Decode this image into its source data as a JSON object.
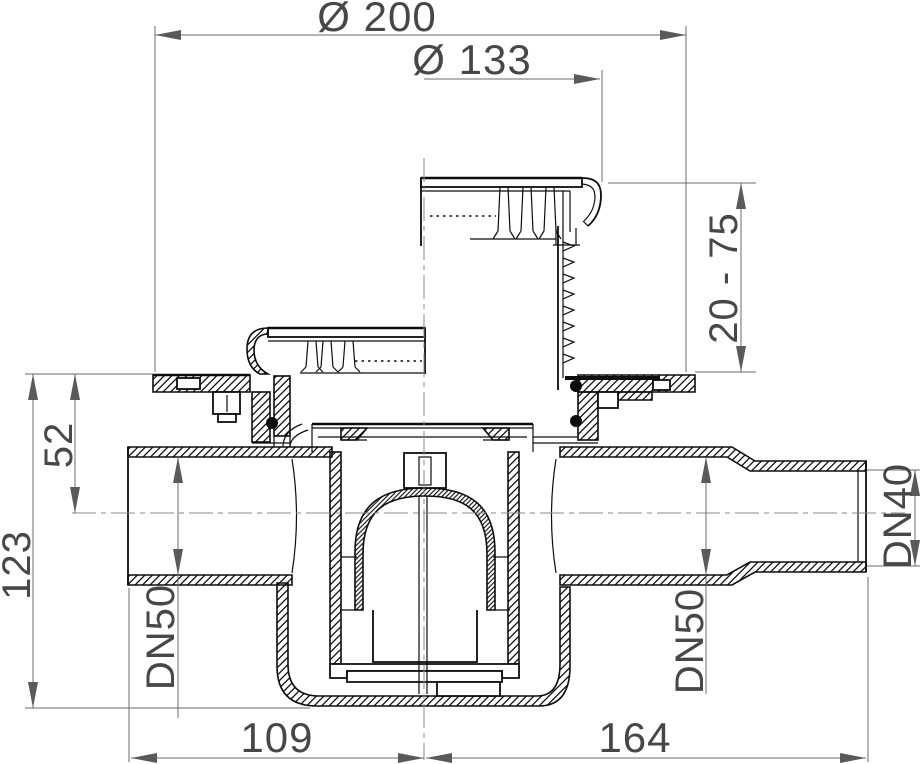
{
  "drawing": {
    "type": "technical-section",
    "subject": "adjustable floor drain cross-section",
    "labels": {
      "outer_diameter": "Ø 200",
      "grate_diameter": "Ø 133",
      "adjust_height": "20 - 75",
      "axis_depth": "52",
      "total_depth": "123",
      "inlet_left": "DN50",
      "outlet_right": "DN50",
      "outlet_end": "DN40",
      "center_to_inlet": "109",
      "center_to_outlet": "164"
    },
    "colors": {
      "line": "#0d0d0d",
      "dimension": "#6b6b6b",
      "text": "#474747",
      "background": "#ffffff"
    }
  }
}
